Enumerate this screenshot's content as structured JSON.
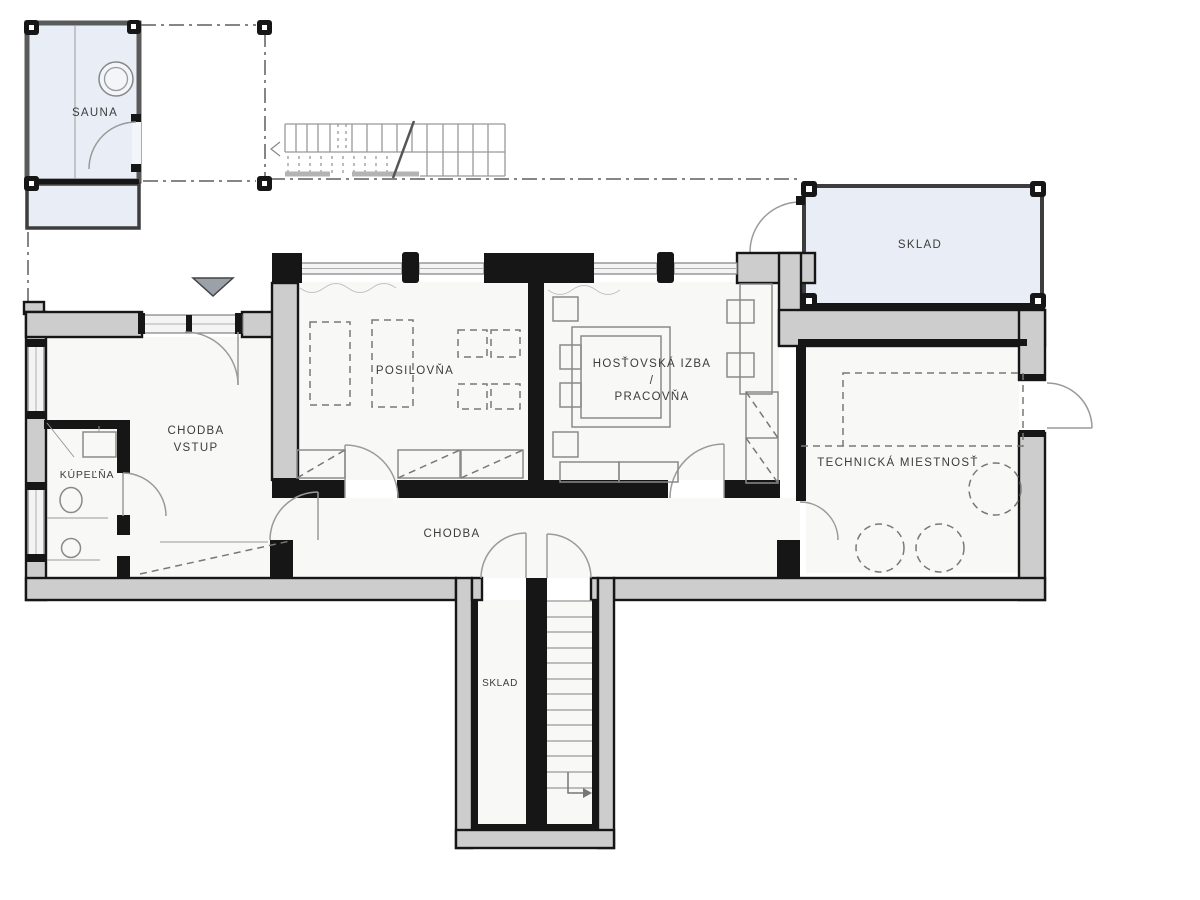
{
  "plan": {
    "type": "basement-floor-plan",
    "rooms": {
      "sauna": {
        "label": "SAUNA"
      },
      "storage_top": {
        "label": "SKLAD"
      },
      "gym": {
        "label": "POSILOVŇA"
      },
      "guest_room": {
        "label_line1": "HOSŤOVSKÁ IZBA",
        "label_separator": "/",
        "label_line2": "PRACOVŇA"
      },
      "entry_hall": {
        "label_line1": "CHODBA",
        "label_line2": "VSTUP"
      },
      "bathroom": {
        "label": "KÚPEĽŇA"
      },
      "hallway": {
        "label": "CHODBA"
      },
      "technical_room": {
        "label": "TECHNICKÁ MIESTNOSŤ"
      },
      "storage_bottom": {
        "label": "SKLAD"
      }
    },
    "colors": {
      "wall_fill": "#cdcdcd",
      "wall_outline": "#161616",
      "cold_room_fill": "#e9eef6",
      "room_fill": "#f8f8f6",
      "door_arc": "#9a9a9a",
      "entrance_marker": "#9aa1a8"
    }
  }
}
